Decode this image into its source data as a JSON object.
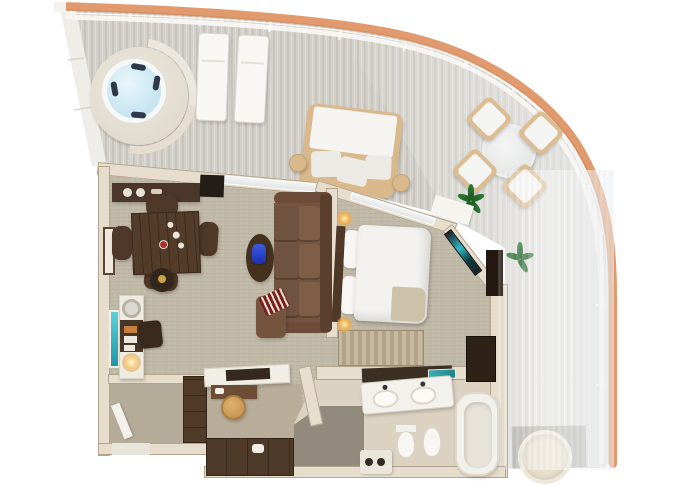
{
  "meta": {
    "width": 680,
    "height": 486,
    "description": "3D top-down rendered floor plan of a suite with wrap-around balcony (no visible text in image)"
  },
  "palette": {
    "bg": "#ffffff",
    "deck": "#d3d0c9",
    "deckStripe": "#bdbab3",
    "hull": "#e09a6d",
    "rail": "#f8f7f4",
    "wall": "#e7ddcd",
    "wallEdge": "#b3a48d",
    "carpet": "#c1b9a8",
    "hallCarpet": "#b4ab99",
    "marble": "#dcd2c2",
    "showerStone": "#918a7d",
    "woodDark": "#4a3729",
    "woodMid": "#6b4e35",
    "sofaBrown": "#74543f",
    "sofaBack": "#5a3f2e",
    "bedWhite": "#f3f2ee",
    "throwBeige": "#cdc1a9",
    "waterBlue": "#cfe9f4",
    "accentTeal": "#2fb9c6",
    "plantGreen": "#2f7d35",
    "vaseBlue": "#2b46d8",
    "lampGlow": "#e8ae53",
    "stoolTan": "#c08c4a",
    "chairWood": "#dcbd92",
    "redPillow": "#7a1f1f"
  },
  "scene": {
    "balcony": {
      "label": "wrap-around balcony",
      "items": [
        "hot-tub",
        "sun-lounger",
        "sun-lounger",
        "daybed",
        "side-table",
        "side-table",
        "outdoor-dining-table",
        "outdoor-chair",
        "outdoor-chair",
        "outdoor-chair",
        "outdoor-chair",
        "potted-plant",
        "potted-plant",
        "deck-mat",
        "round-lounger",
        "railing",
        "hull-trim",
        "balcony-step"
      ]
    },
    "dining_area": {
      "label": "dining area",
      "items": [
        "dining-table",
        "dining-chair",
        "dining-chair",
        "dining-chair",
        "dining-chair",
        "wine-stand",
        "sideboard",
        "wall-art",
        "bar-counter",
        "bar-sink",
        "minibar",
        "teal-cabinet",
        "desk-chair",
        "coffee-station"
      ]
    },
    "living_room": {
      "label": "living room",
      "items": [
        "sectional-sofa",
        "chaise",
        "striped-pillow",
        "oval-side-table",
        "blue-vase",
        "sliding-door"
      ]
    },
    "bedroom": {
      "label": "bedroom",
      "items": [
        "king-bed",
        "pillows",
        "throw-blanket",
        "headboard",
        "bedside-lamp",
        "bedside-lamp",
        "wall-tv",
        "media-cabinet",
        "wardrobe",
        "closet-curtain",
        "sliding-door"
      ]
    },
    "entry_hall": {
      "label": "entry hallway",
      "items": [
        "entry-door",
        "hall-closet"
      ]
    },
    "dressing_room": {
      "label": "dressing room",
      "items": [
        "vanity-counter",
        "vanity-tray",
        "vanity-desk",
        "stool",
        "wardrobe-bank",
        "slippers"
      ]
    },
    "bathroom": {
      "label": "bathroom",
      "items": [
        "double-vanity",
        "sink",
        "sink",
        "toiletry-shelf",
        "teal-tray",
        "toilet",
        "bidet",
        "bathtub",
        "walk-in-shower",
        "shower-bench"
      ]
    }
  }
}
